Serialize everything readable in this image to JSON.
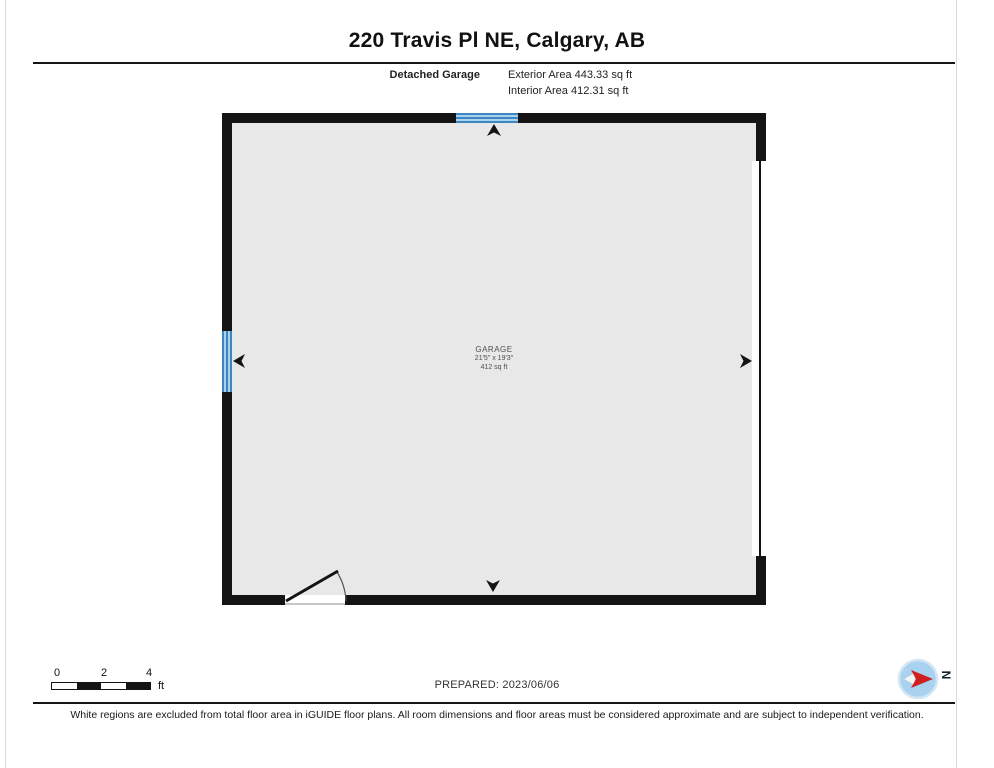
{
  "header": {
    "title": "220 Travis Pl NE, Calgary, AB",
    "floor_name": "Detached Garage",
    "exterior_area": "Exterior Area 443.33 sq ft",
    "interior_area": "Interior Area 412.31 sq ft"
  },
  "plan": {
    "room": {
      "name": "GARAGE",
      "dimensions": "21'5\" x 19'3\"",
      "area": "412 sq ft"
    },
    "colors": {
      "wall": "#141414",
      "floor_fill": "#e8e8e8",
      "window_light": "#a9d2ec",
      "window_dark": "#3e86c2"
    }
  },
  "scale_bar": {
    "ticks": [
      "0",
      "2",
      "4"
    ],
    "unit": "ft"
  },
  "prepared_label": "PREPARED: 2023/06/06",
  "compass": {
    "north_label": "N",
    "needle_color": "#cf1f1f",
    "disc_color": "#a8d2ef"
  },
  "disclaimer": "White regions are excluded from total floor area in iGUIDE floor plans. All room dimensions and floor areas must be considered approximate and are subject to independent verification."
}
